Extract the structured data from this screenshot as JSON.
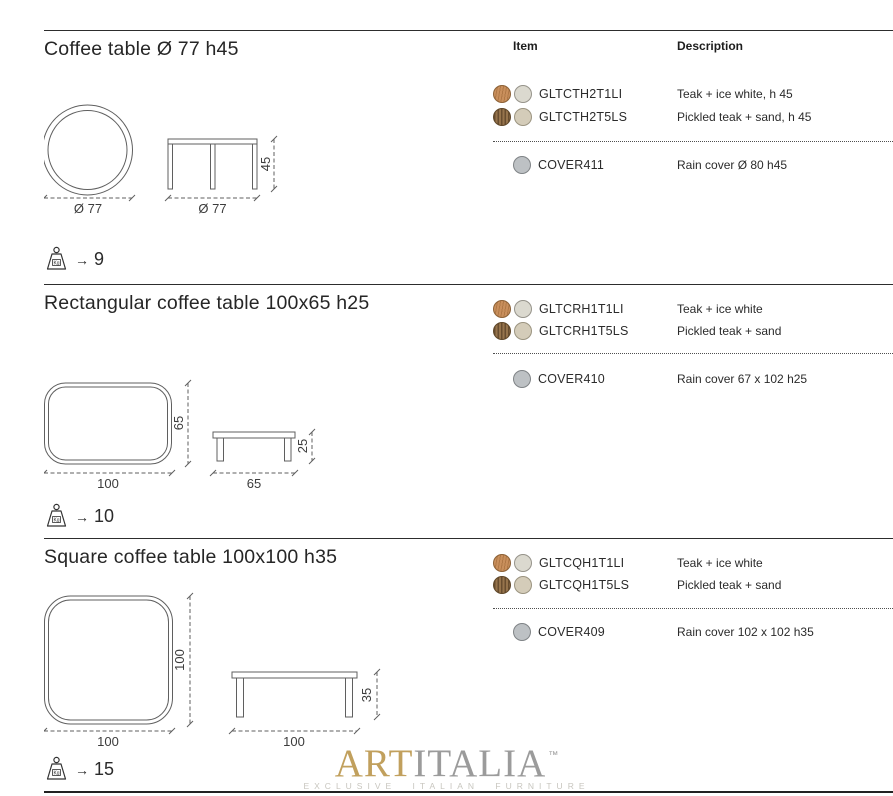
{
  "columns": {
    "item": "Item",
    "description": "Description"
  },
  "sections": [
    {
      "title": "Coffee table Ø 77 h45",
      "drawing": {
        "plan_dim": "Ø 77",
        "side_width_dim": "Ø 77",
        "side_height_dim": "45"
      },
      "weight": {
        "unit": "Kg",
        "arrow": "→",
        "value": "9"
      },
      "items": [
        {
          "swatches": [
            "teak",
            "ice-white"
          ],
          "code": "GLTCTH2T1LI",
          "description": "Teak + ice white, h 45"
        },
        {
          "swatches": [
            "pickled-teak",
            "sand"
          ],
          "code": "GLTCTH2T5LS",
          "description": "Pickled teak + sand, h 45"
        }
      ],
      "cover": {
        "swatch": "rain-cover-grey",
        "code": "COVER411",
        "description": "Rain cover Ø 80 h45"
      }
    },
    {
      "title": "Rectangular coffee table 100x65 h25",
      "drawing": {
        "plan_width_dim": "100",
        "plan_height_dim": "65",
        "side_width_dim": "65",
        "side_height_dim": "25"
      },
      "weight": {
        "unit": "Kg",
        "arrow": "→",
        "value": "10"
      },
      "items": [
        {
          "swatches": [
            "teak",
            "ice-white"
          ],
          "code": "GLTCRH1T1LI",
          "description": "Teak + ice white"
        },
        {
          "swatches": [
            "pickled-teak",
            "sand"
          ],
          "code": "GLTCRH1T5LS",
          "description": "Pickled teak + sand"
        }
      ],
      "cover": {
        "swatch": "rain-cover-grey",
        "code": "COVER410",
        "description": "Rain cover 67 x 102 h25"
      }
    },
    {
      "title": "Square coffee table 100x100 h35",
      "drawing": {
        "plan_width_dim": "100",
        "plan_height_dim": "100",
        "side_width_dim": "100",
        "side_height_dim": "35"
      },
      "weight": {
        "unit": "Kg",
        "arrow": "→",
        "value": "15"
      },
      "items": [
        {
          "swatches": [
            "teak",
            "ice-white"
          ],
          "code": "GLTCQH1T1LI",
          "description": "Teak + ice white"
        },
        {
          "swatches": [
            "pickled-teak",
            "sand"
          ],
          "code": "GLTCQH1T5LS",
          "description": "Pickled teak + sand"
        }
      ],
      "cover": {
        "swatch": "rain-cover-grey",
        "code": "COVER409",
        "description": "Rain cover 102 x 102 h35"
      }
    }
  ],
  "footer": {
    "brand_part1": "ART",
    "brand_part2": "ITALIA",
    "trademark": "™",
    "tagline": "EXCLUSIVE ITALIAN FURNITURE"
  },
  "colors": {
    "teak": "#c98f5c",
    "ice_white": "#dbd9cf",
    "pickled_teak": "#96744c",
    "sand": "#d4ccb9",
    "rain_cover": "#bdc1c4",
    "logo_gold": "#c1a05d",
    "logo_grey": "#9b9b9b",
    "text": "#2b2b2b"
  }
}
